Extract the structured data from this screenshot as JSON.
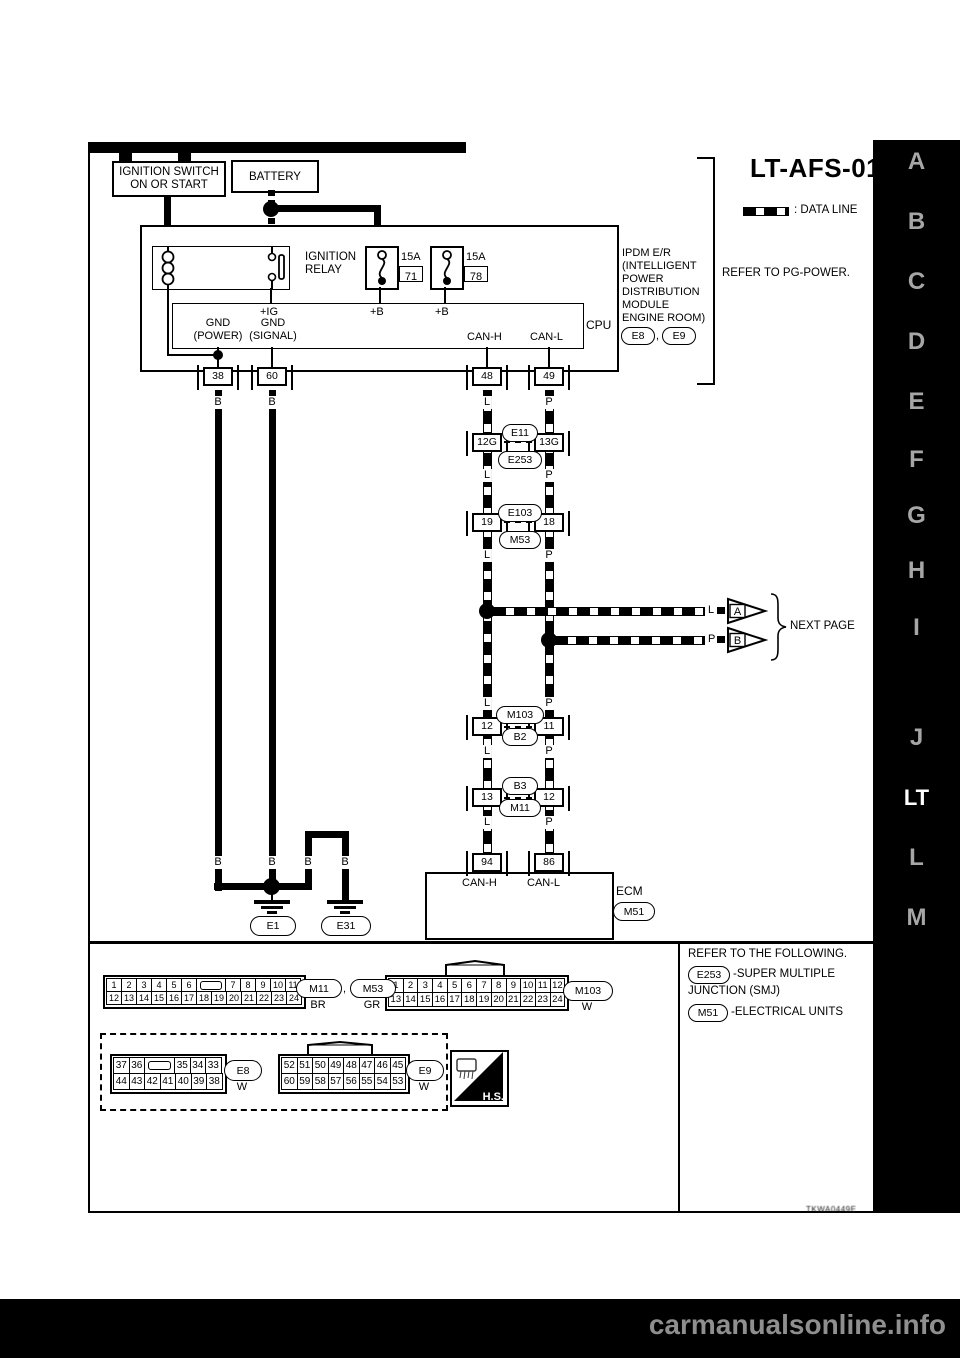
{
  "page": {
    "title": "LT-AFS-01",
    "watermark": "carmanualsonline.info",
    "doc_code": "TKWA0449E"
  },
  "sidebar": {
    "letters": [
      "A",
      "B",
      "C",
      "D",
      "E",
      "F",
      "G",
      "H",
      "I",
      "J",
      "LT",
      "L",
      "M"
    ],
    "active": "LT"
  },
  "legend": {
    "data_line": ": DATA LINE",
    "refer_pg": "REFER TO PG-POWER."
  },
  "sources": {
    "ignition_switch": "IGNITION SWITCH\nON OR START",
    "battery": "BATTERY"
  },
  "ipdm": {
    "relay": "IGNITION\nRELAY",
    "fuse1_amp": "15A",
    "fuse1_no": "71",
    "fuse2_amp": "15A",
    "fuse2_no": "78",
    "ig": "+IG",
    "b1": "+B",
    "b2": "+B",
    "gnd_power": "GND\n(POWER)",
    "gnd_signal": "GND\n(SIGNAL)",
    "can_h": "CAN-H",
    "can_l": "CAN-L",
    "cpu": "CPU",
    "name": "IPDM E/R\n(INTELLIGENT\nPOWER\nDISTRIBUTION\nMODULE\nENGINE ROOM)",
    "conn_a": "E8",
    "conn_b": "E9",
    "comma": ",",
    "pin38": "38",
    "pin60": "60",
    "pin48": "48",
    "pin49": "49"
  },
  "wire_colors": {
    "b": "B",
    "l": "L",
    "p": "P"
  },
  "junctions": [
    {
      "lpin": "12G",
      "rpin": "13G",
      "top": "E11",
      "bottom": "E253"
    },
    {
      "lpin": "19",
      "rpin": "18",
      "top": "E103",
      "bottom": "M53"
    },
    {
      "lpin": "12",
      "rpin": "11",
      "top": "M103",
      "bottom": "B2"
    },
    {
      "lpin": "13",
      "rpin": "12",
      "top": "B3",
      "bottom": "M11"
    }
  ],
  "next_page": {
    "label": "NEXT PAGE",
    "wire_l": "L",
    "wire_p": "P",
    "arrow_a": "A",
    "arrow_b": "B"
  },
  "ecm": {
    "pin94": "94",
    "pin86": "86",
    "can_h": "CAN-H",
    "can_l": "CAN-L",
    "name": "ECM",
    "conn": "M51"
  },
  "grounds": {
    "e1": "E1",
    "e31": "E31"
  },
  "footer": {
    "refer": "REFER TO THE FOLLOWING.",
    "ref1_code": "E253",
    "ref1_line1": "-SUPER MULTIPLE",
    "ref1_line2": "JUNCTION (SMJ)",
    "ref2_code": "M51",
    "ref2_desc": "-ELECTRICAL UNITS",
    "hs": "H.S."
  },
  "connector_views": {
    "m11_m53": {
      "rows": [
        [
          "1",
          "2",
          "3",
          "4",
          "5",
          "6",
          "SLOT",
          "7",
          "8",
          "9",
          "10",
          "11"
        ],
        [
          "12",
          "13",
          "14",
          "15",
          "16",
          "17",
          "18",
          "19",
          "20",
          "21",
          "22",
          "23",
          "24"
        ]
      ],
      "label1": "M11",
      "comma": ",",
      "label2": "M53",
      "color1": "BR",
      "color2": "GR"
    },
    "m103": {
      "rows": [
        [
          "1",
          "2",
          "3",
          "4",
          "5",
          "6",
          "7",
          "8",
          "9",
          "10",
          "11",
          "12"
        ],
        [
          "13",
          "14",
          "15",
          "16",
          "17",
          "18",
          "19",
          "20",
          "21",
          "22",
          "23",
          "24"
        ]
      ],
      "label": "M103",
      "color": "W"
    },
    "e8": {
      "rows": [
        [
          "37",
          "36",
          "SLOT",
          "35",
          "34",
          "33"
        ],
        [
          "44",
          "43",
          "42",
          "41",
          "40",
          "39",
          "38"
        ]
      ],
      "label": "E8",
      "color": "W"
    },
    "e9": {
      "rows": [
        [
          "52",
          "51",
          "50",
          "49",
          "48",
          "47",
          "46",
          "45"
        ],
        [
          "60",
          "59",
          "58",
          "57",
          "56",
          "55",
          "54",
          "53"
        ]
      ],
      "label": "E9",
      "color": "W"
    }
  }
}
